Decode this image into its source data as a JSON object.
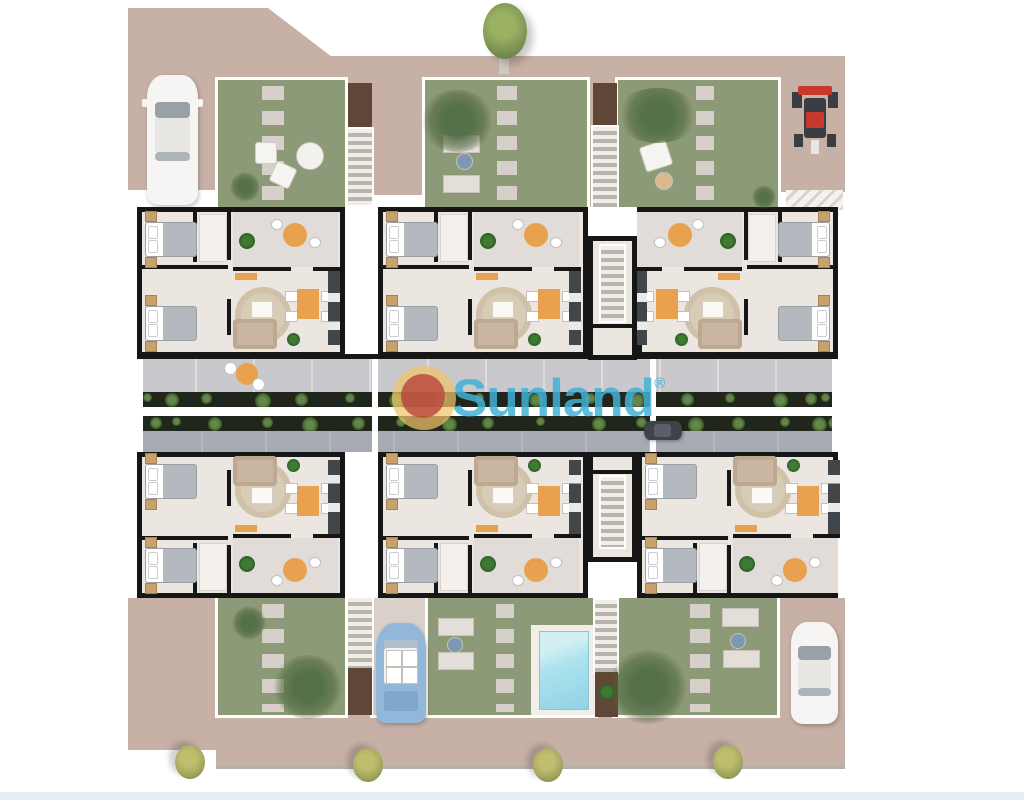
{
  "watermark": {
    "brand": "Sunland",
    "registered_mark": "®"
  },
  "palette": {
    "street": "#c7b1a6",
    "street_light": "#d9d0c9",
    "grass": "#8d9a77",
    "stone": "#d6cfca",
    "wall": "#161616",
    "unit_floor": "#ece6e1",
    "terrace": "#c9c9cd",
    "walkway": "#a6aab2",
    "planter": "#20261b",
    "palm": "#55714a",
    "pool_water_light": "#d2f0f4",
    "pool_water": "#8fd2e4",
    "pool_deck": "#f1eeea",
    "accent_orange": "#e8a14e",
    "rug": "#d9ccb6",
    "sofa": "#c9b5a2",
    "bed_blanket": "#b4b8bf",
    "nightstand": "#c9a26b",
    "kitchen": "#41464b",
    "car_white": "#f6f5f3",
    "car_blue": "#93b7d8",
    "car_dark": "#3e434a",
    "tractor_red": "#c8392b",
    "tree": "#7f9454",
    "bush": "#a2a75e",
    "logo_blue": "rgba(66,178,214,0.85)",
    "logo_gold": "rgba(240,196,105,0.72)",
    "logo_red": "rgba(184,71,61,0.82)"
  },
  "scene_objects": {
    "vehicles": [
      "white-car-top-left",
      "red-tractor-top-right",
      "blue-convertible-bottom",
      "dark-car-road",
      "white-car-bottom-right"
    ],
    "features": [
      "six-apartment-units",
      "central-road-with-planters",
      "swimming-pool",
      "gardens-with-stepping-stones",
      "staircases",
      "trees-and-bushes"
    ]
  }
}
